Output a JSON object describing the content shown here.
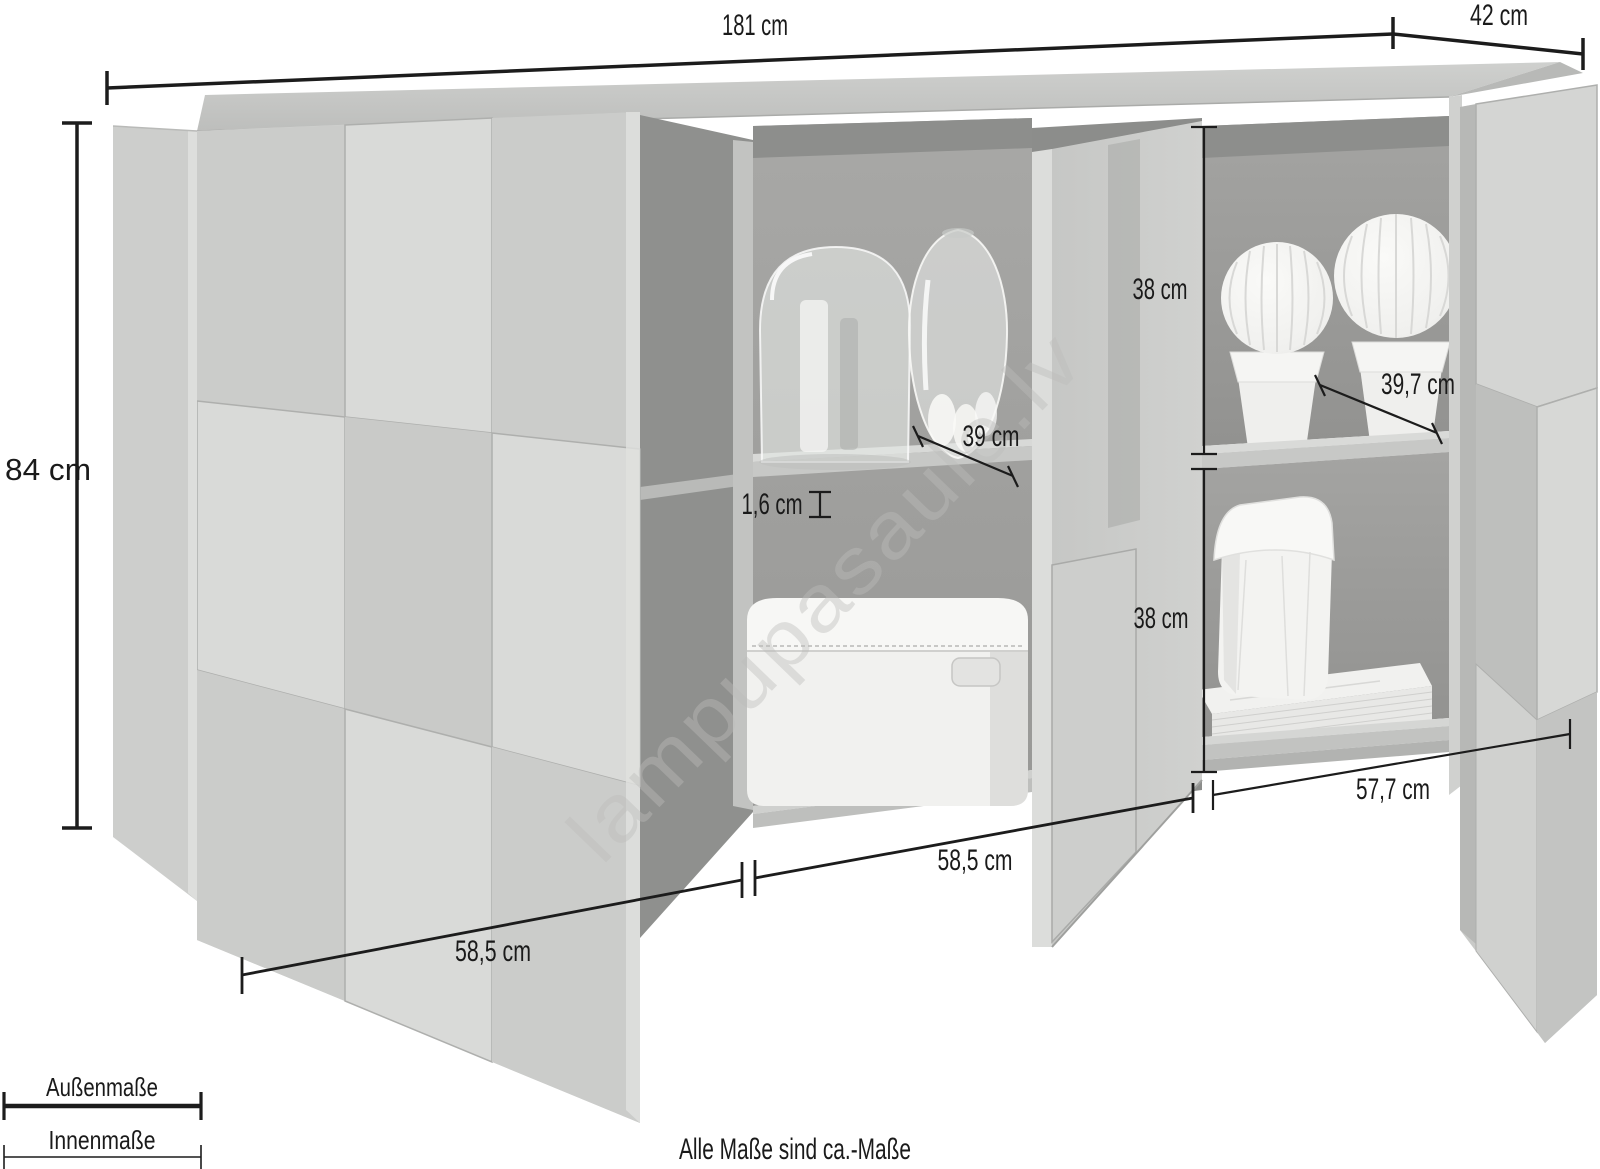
{
  "colors": {
    "background": "#ffffff",
    "dimension_line": "#1c1c1c",
    "label_text": "#1a1a1a",
    "concrete_light": "#d3d4d2",
    "concrete_shadow": "#bfc0be",
    "interior_gray": "#9d9d9b",
    "watermark_gray": "#bdbdbb"
  },
  "dimensions": {
    "overall_width": "181 cm",
    "overall_depth": "42 cm",
    "overall_height": "84 cm",
    "right_upper_compartment_height": "38 cm",
    "right_lower_compartment_height": "38 cm",
    "middle_inner_depth": "39 cm",
    "right_inner_depth": "39,7 cm",
    "shelf_thickness": "1,6 cm",
    "left_door_width": "58,5 cm",
    "middle_door_width": "58,5 cm",
    "right_inner_width": "57,7 cm"
  },
  "legend": {
    "outer": "Außenmaße",
    "inner": "Innenmaße"
  },
  "note": "Alle Maße sind ca.-Maße",
  "watermark": "lampupasaule.lv"
}
